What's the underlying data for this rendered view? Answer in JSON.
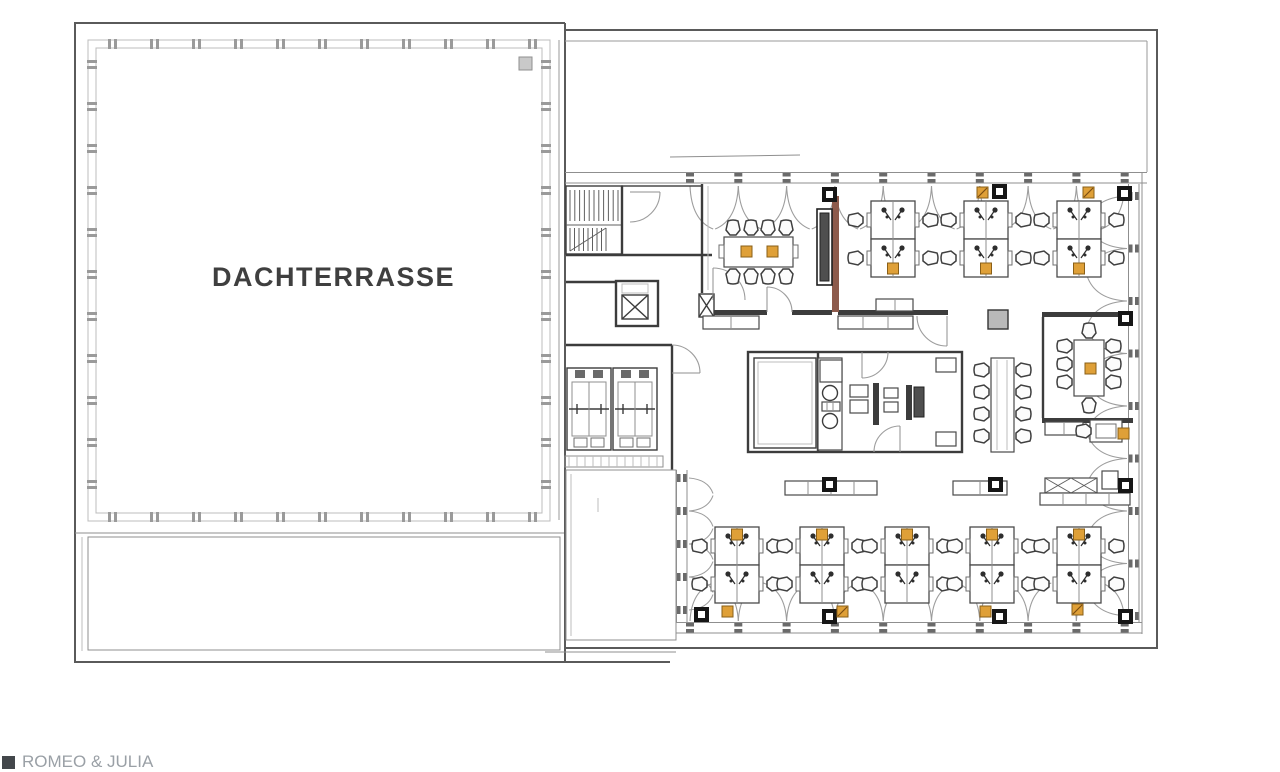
{
  "page": {
    "terrace_label": "DACHTERRASSE",
    "footer_brand": "ROMEO & JULIA"
  },
  "colors": {
    "wall": "#3c3c3c",
    "light_line": "#9a9a9a",
    "accent_orange": "#dfa038",
    "accent_orange_border": "#8a5f17",
    "accent_brown_wall": "#8d5a4b",
    "screen_dark": "#4f4f4f",
    "column_black": "#161616",
    "column_gray_fill": "#b9b9b9",
    "background": "#ffffff"
  },
  "plan": {
    "desk_cluster": {
      "w": 44,
      "desk_h": 38
    },
    "top_clusters": [
      {
        "x": 871,
        "y": 201
      },
      {
        "x": 964,
        "y": 201
      },
      {
        "x": 1057,
        "y": 201
      }
    ],
    "bottom_clusters": [
      {
        "x": 715,
        "y": 527
      },
      {
        "x": 800,
        "y": 527
      },
      {
        "x": 885,
        "y": 527
      },
      {
        "x": 970,
        "y": 527
      },
      {
        "x": 1057,
        "y": 527
      }
    ],
    "columns_black": [
      [
        822,
        187
      ],
      [
        992,
        184
      ],
      [
        1117,
        186
      ],
      [
        1118,
        311
      ],
      [
        822,
        477
      ],
      [
        988,
        477
      ],
      [
        1118,
        478
      ],
      [
        694,
        607
      ],
      [
        822,
        609
      ],
      [
        992,
        609
      ],
      [
        1118,
        609
      ]
    ],
    "column_gray": [
      988,
      310,
      20,
      19
    ],
    "orange_plain": [
      [
        741,
        246
      ],
      [
        767,
        246
      ],
      [
        1085,
        363
      ],
      [
        1118,
        428
      ],
      [
        722,
        606
      ],
      [
        980,
        606
      ]
    ],
    "orange_hatched": [
      [
        977,
        187
      ],
      [
        1083,
        187
      ],
      [
        837,
        606
      ],
      [
        1072,
        604
      ]
    ],
    "window_scallops": [
      {
        "x": 690,
        "y": 186,
        "bays": 9,
        "w": 48.3,
        "depth": 43,
        "dir": "down"
      },
      {
        "x": 690,
        "y": 621,
        "bays": 9,
        "w": 48.3,
        "depth": 38,
        "dir": "up"
      },
      {
        "x": 1127,
        "y": 196,
        "bays": 8,
        "w": 52.5,
        "depth": 40,
        "dir": "left"
      },
      {
        "x": 689,
        "y": 478,
        "bays": 4,
        "w": 33,
        "depth": 24,
        "dir": "right"
      }
    ],
    "mullion_bands": [
      {
        "o": "h",
        "a": 565,
        "b": 1147,
        "c": 172,
        "t": 11,
        "start": 690,
        "step": 48.3,
        "n": 10
      },
      {
        "o": "h",
        "a": 676,
        "b": 1142,
        "c": 622,
        "t": 11,
        "start": 690,
        "step": 48.3,
        "n": 10
      },
      {
        "o": "v",
        "a": 184,
        "b": 622,
        "c": 1128,
        "t": 11,
        "start": 196,
        "step": 52.5,
        "n": 9
      },
      {
        "o": "v",
        "a": 470,
        "b": 622,
        "c": 676,
        "t": 11,
        "start": 478,
        "step": 33,
        "n": 5
      }
    ],
    "railing": {
      "x": 88,
      "y": 40,
      "w": 462,
      "h": 481,
      "step": 42
    },
    "long_table_chairs_y": [
      370,
      392,
      414,
      436
    ],
    "meeting_table_chairs_x": [
      733,
      751,
      768,
      786
    ],
    "small_room_chairs_y": [
      346,
      364,
      382
    ]
  }
}
